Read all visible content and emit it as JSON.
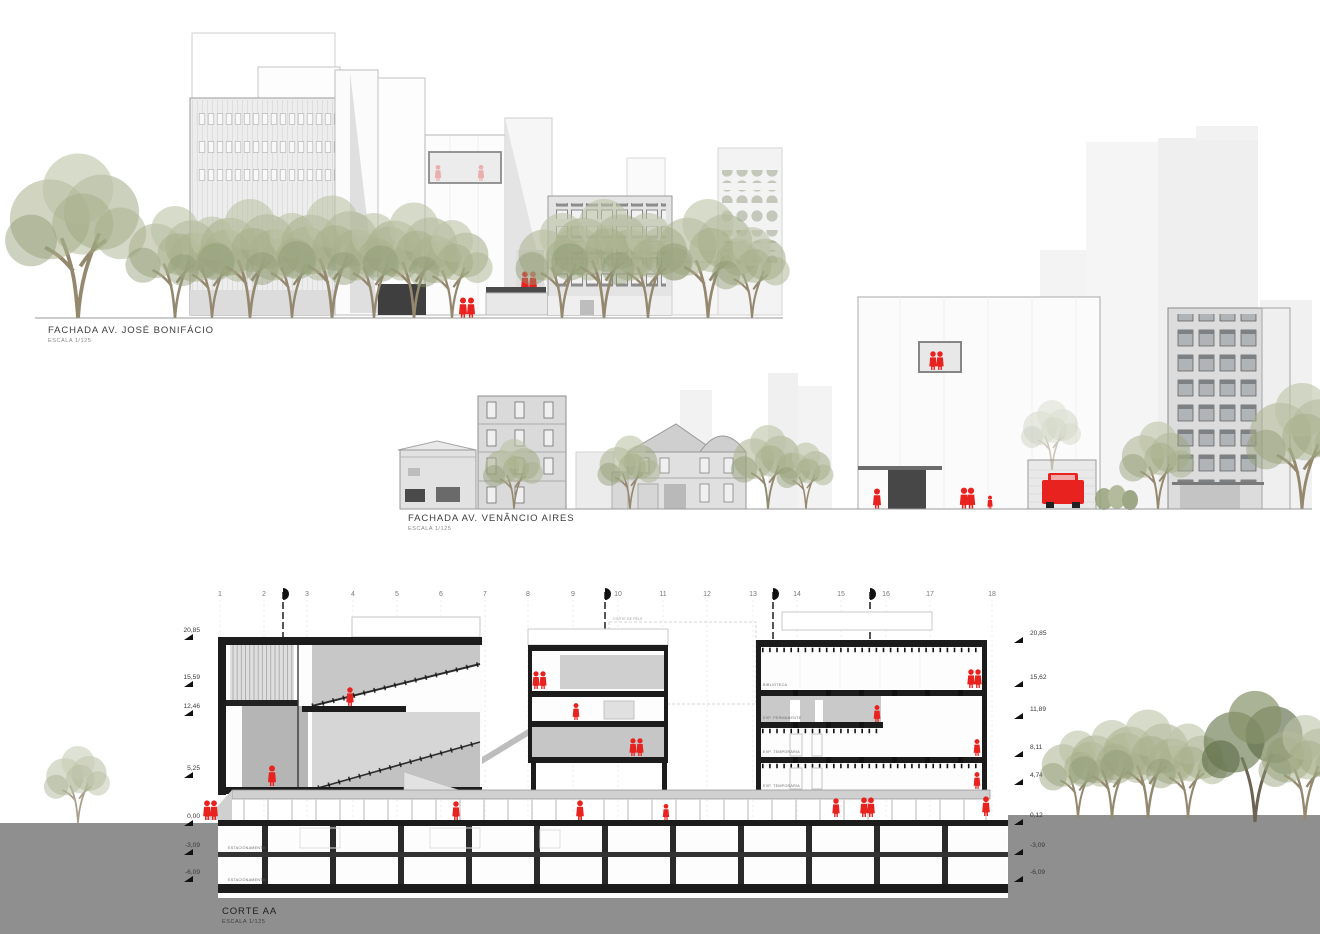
{
  "drawings": {
    "fachada_jose_bonifacio": {
      "title": "FACHADA AV. JOSÉ BONIFÁCIO",
      "scale": "ESCALA 1/125"
    },
    "fachada_venancio_aires": {
      "title": "FACHADA AV. VENÂNCIO AIRES",
      "scale": "ESCALA 1/125"
    },
    "corte_aa": {
      "title": "CORTE AA",
      "scale": "ESCALA 1/125"
    }
  },
  "section": {
    "grid_numbers": [
      "1",
      "2",
      "3",
      "4",
      "5",
      "6",
      "7",
      "8",
      "9",
      "10",
      "11",
      "12",
      "13",
      "14",
      "15",
      "16",
      "17",
      "18"
    ],
    "levels_left": [
      "20,85",
      "15,59",
      "12,46",
      "5,25",
      "0,00",
      "-3,09",
      "-6,09"
    ],
    "levels_right": [
      "20,85",
      "15,62",
      "11,89",
      "8,11",
      "4,74",
      "0,12",
      "-3,09",
      "-6,09"
    ],
    "rooms": {
      "biblioteca": "BIBLIOTECA",
      "exp_permanente": "EXP. PERMANENTE",
      "exp_temporaria_1": "EXP. TEMPORÁRIA",
      "exp_temporaria_2": "EXP. TEMPORÁRIA",
      "estacionamento_1": "ESTACIONAMENTO",
      "estacionamento_2": "ESTACIONAMENTO"
    },
    "annotations": {
      "corte_de_pele": "CORTE DE PELE"
    }
  },
  "colors": {
    "accent_red": "#e8221f",
    "ground_gray": "#8f8f8f",
    "slab_black": "#1c1c1c",
    "tree_olive": "#a3ab87",
    "tree_dark": "#6f7f57"
  }
}
